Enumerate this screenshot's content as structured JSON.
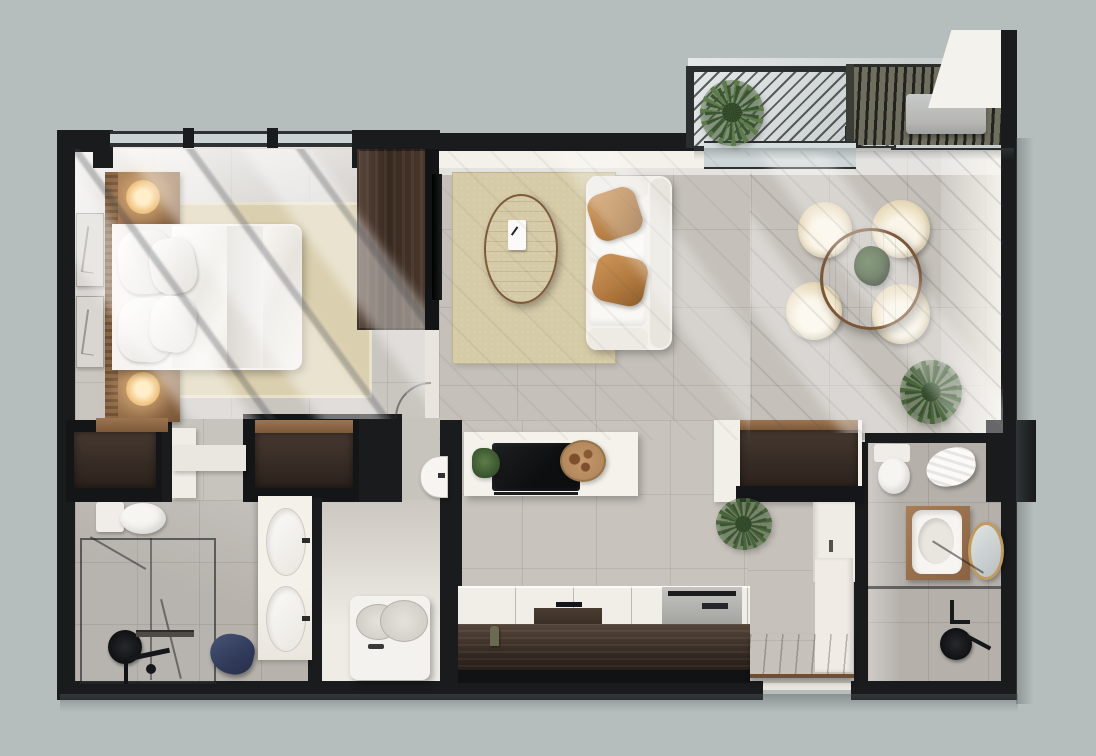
{
  "scene": {
    "title": "apartment-floor-plan-3d-render",
    "view": "top-down",
    "canvas": {
      "width": 1096,
      "height": 756
    },
    "palette": {
      "bg": "#b6bdbd",
      "wall": "#1a1b1d",
      "white": "#f6f4f0",
      "tile": "#c6c1bb",
      "tileDark": "#b5b0aa",
      "wood": "#9a7350",
      "woodLight": "#c49a6c",
      "woodDark": "#443629",
      "cabinet": "#2f2823",
      "cream": "#e9dcc0",
      "rug": "#d6cba7",
      "bedRug": "#dacfae",
      "bronze": "#b57d42",
      "green": "#47663a",
      "greenDark": "#2c4023",
      "blue": "#3e4968",
      "lamp": "#f2c98b",
      "glass": "#ccd3d4",
      "steel": "#b7b6b2",
      "gold": "#c29a5c"
    },
    "rooms": {
      "bedroom": {
        "furniture": [
          "double-bed",
          "four-pillows",
          "duvet",
          "gray-throw",
          "beige-area-rug",
          "nightstand-upper",
          "nightstand-lower",
          "glowing-table-lamps",
          "wood-slat-headboard-wall",
          "dark-wood-wardrobe",
          "two-wall-art-frames",
          "window-with-light-shafts"
        ]
      },
      "living_room": {
        "furniture": [
          "white-sofa",
          "two-bronze-cushions",
          "jute-rug",
          "oval-wood-coffee-table",
          "white-book",
          "tv-panel-on-dark-wall"
        ]
      },
      "dining_area": {
        "furniture": [
          "round-wood-table",
          "green-centerpiece-plant",
          "four-cream-chairs",
          "potted-floor-plant"
        ]
      },
      "balcony": {
        "furniture": [
          "metal-mesh-railing",
          "louvered-pergola",
          "ac-unit",
          "potted-plant",
          "sliding-glass-door"
        ]
      },
      "kitchen": {
        "furniture": [
          "island-with-black-cooktop",
          "round-serving-tray",
          "herb-sprig",
          "white-counter-run",
          "recessed-sink",
          "stainless-range",
          "bottle",
          "dark-wood-cabinet-fronts"
        ]
      },
      "hallway_closet": {
        "furniture": [
          "dark-dresser-left",
          "dark-dresser-right",
          "white-bench",
          "wall-hung-basin",
          "hall-cabinet",
          "tall-white-unit",
          "potted-plant",
          "door-swing-arc"
        ]
      },
      "laundry": {
        "furniture": [
          "washing-machine-top-load"
        ]
      },
      "bathroom_main": {
        "furniture": [
          "toilet",
          "walk-in-glass-shower",
          "black-shower-head",
          "linear-drain",
          "blue-towel",
          "double-sink-vanity"
        ]
      },
      "bathroom_guest": {
        "furniture": [
          "toilet",
          "white-towel",
          "wood-vanity-with-basin",
          "gold-oval-mirror",
          "glass-partition",
          "black-shower-head",
          "shower-fixture"
        ]
      },
      "entry": {
        "furniture": [
          "wood-floor-mat",
          "white-wall-band"
        ]
      }
    },
    "counts": {
      "dining_chairs": 4,
      "bed_pillows": 4,
      "vanity_sinks_main": 2,
      "washer_lids": 2,
      "art_frames": 2
    }
  }
}
